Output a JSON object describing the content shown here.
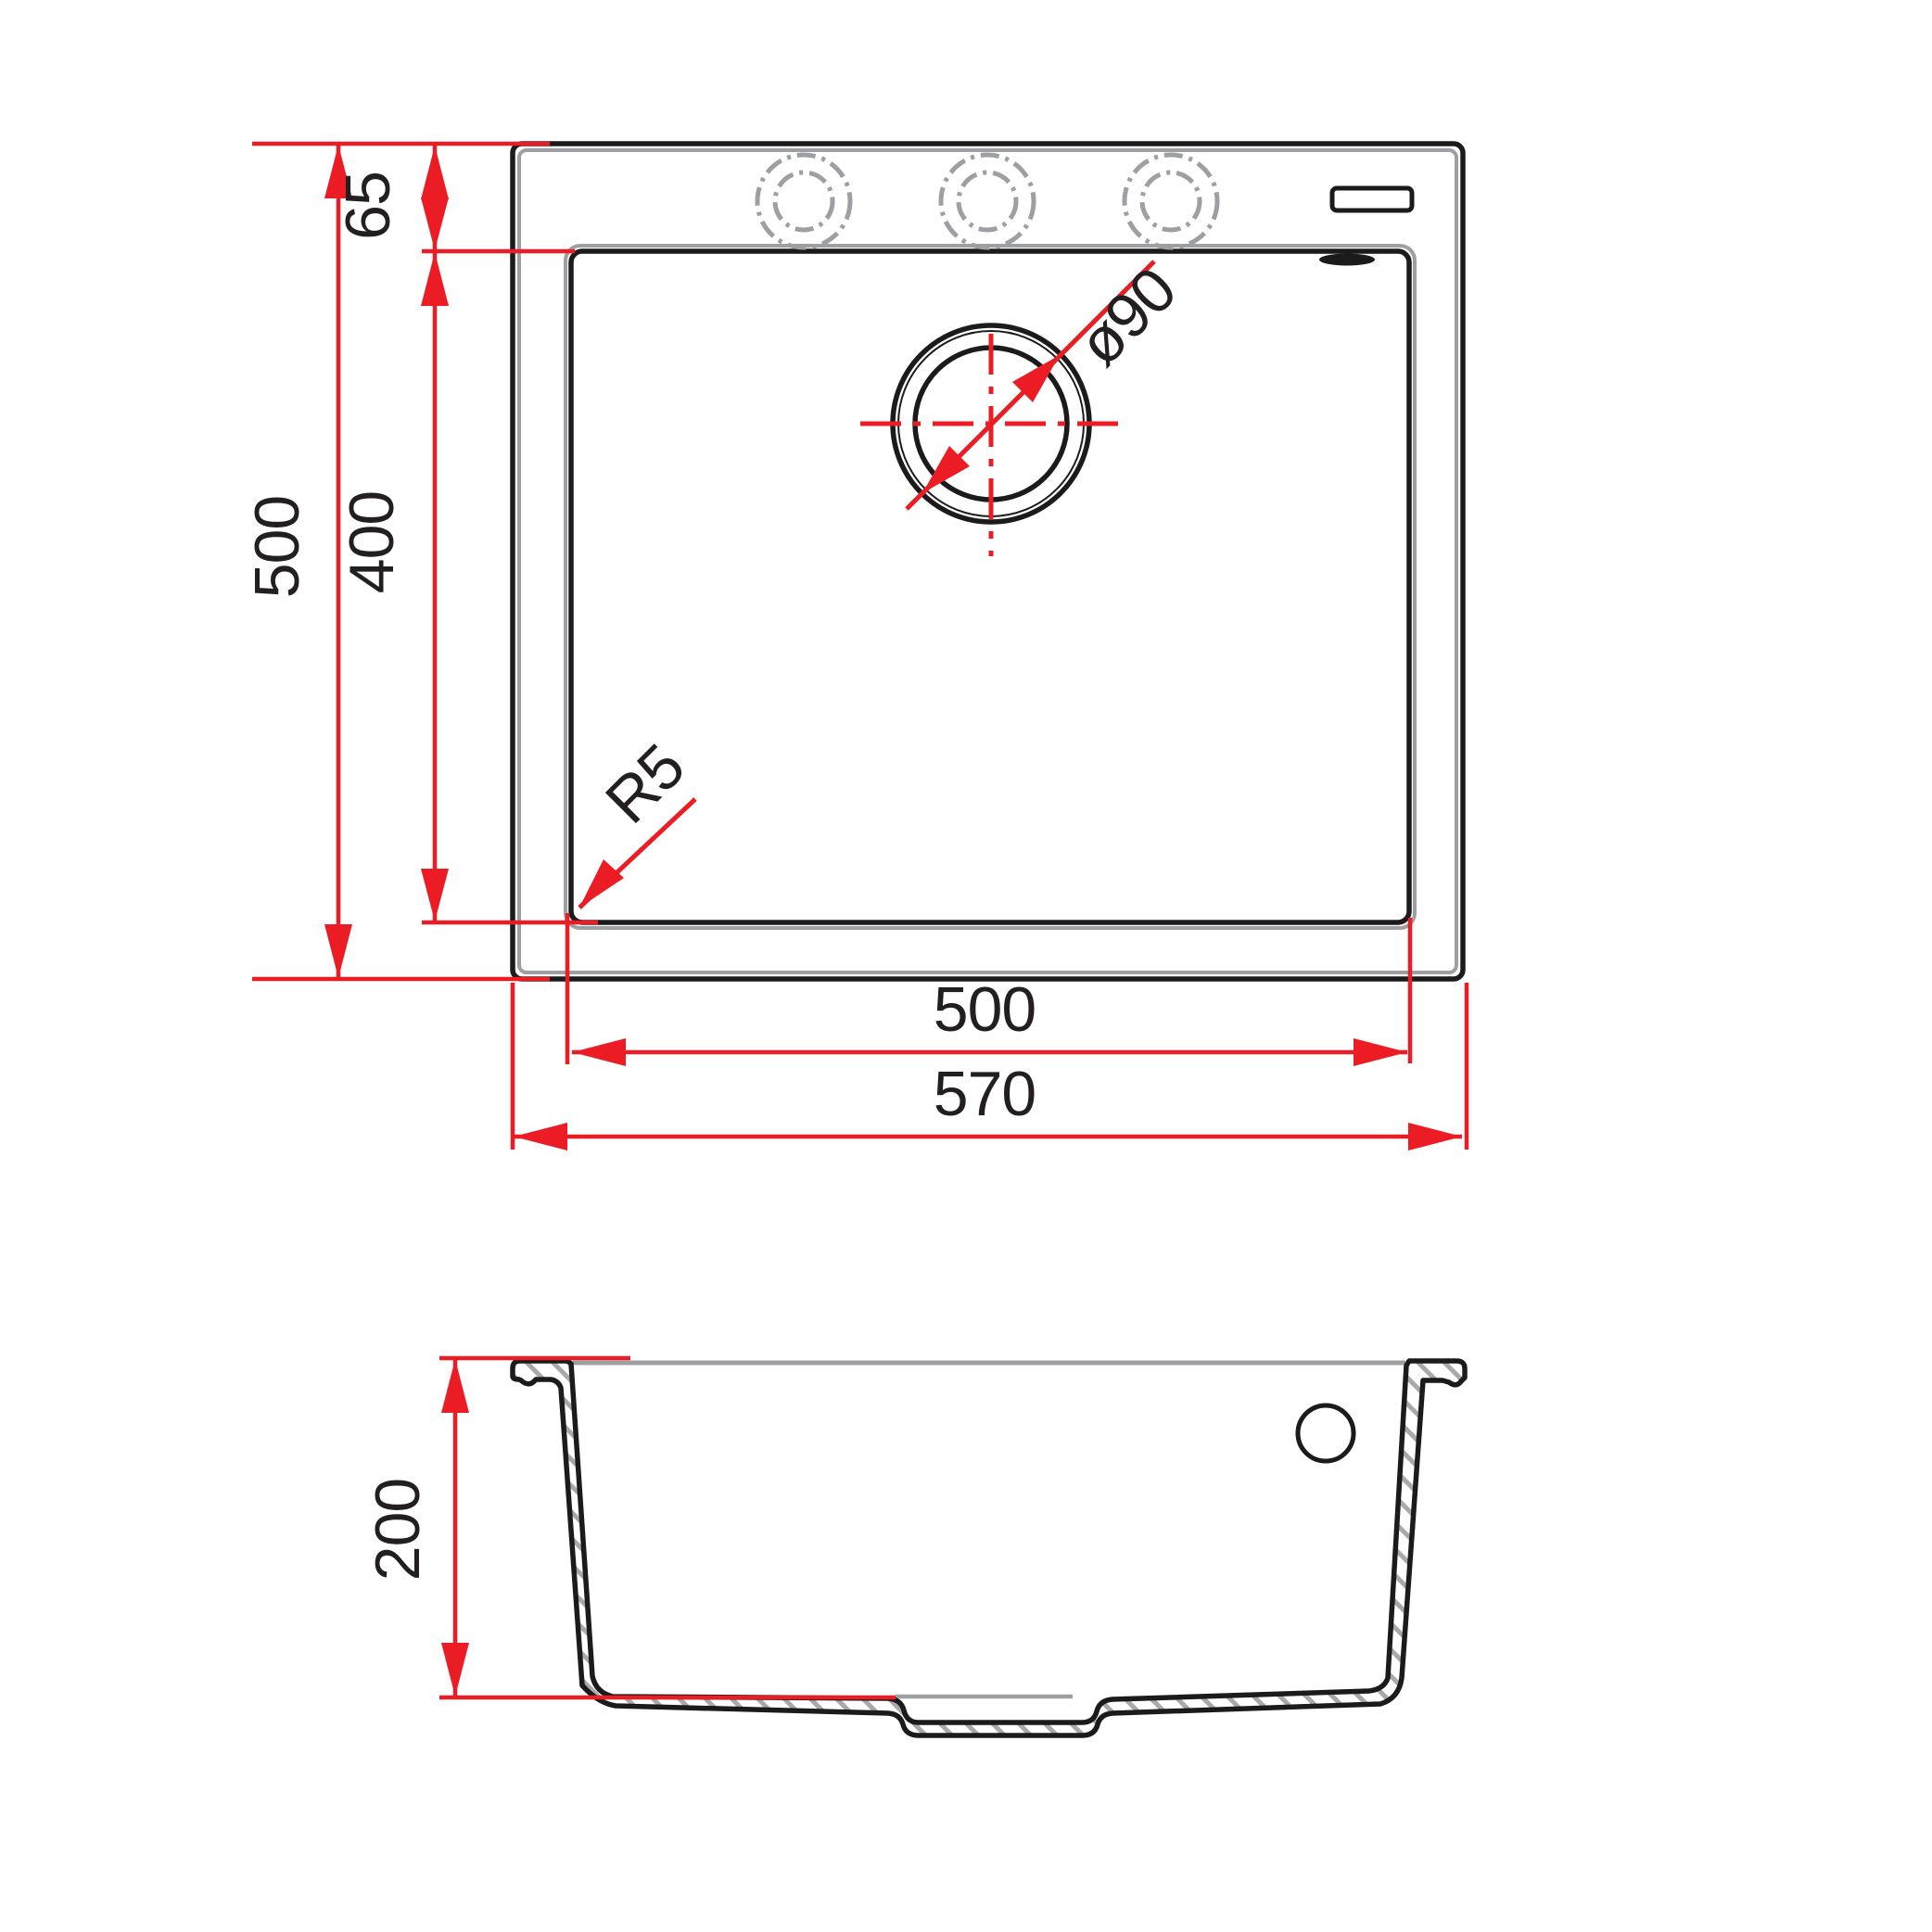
{
  "colors": {
    "dimension_red": "#ec1c24",
    "outline_black": "#1b1b1b",
    "secondary_gray": "#9d9fa2",
    "hatch_gray": "#a7a9ac",
    "background": "#ffffff"
  },
  "plan_view": {
    "faucet_holes": 3,
    "dims": {
      "top_offset": "65",
      "overall_height": "500",
      "basin_height": "400",
      "basin_width": "500",
      "overall_width": "570",
      "drain_diameter": "ø90",
      "corner_radius": "R5"
    }
  },
  "section_view": {
    "dims": {
      "bowl_depth": "200"
    }
  }
}
